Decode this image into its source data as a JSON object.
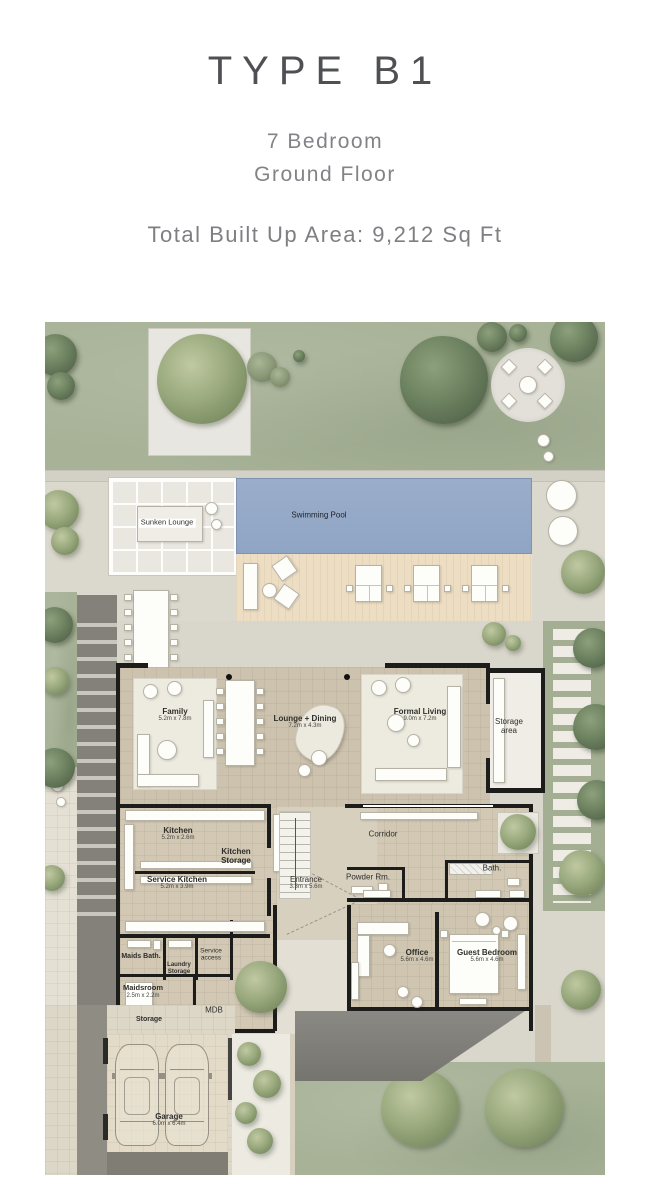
{
  "header": {
    "title": "TYPE B1",
    "subtitle_line1": "7 Bedroom",
    "subtitle_line2": "Ground Floor",
    "area_text": "Total Built Up Area: 9,212 Sq Ft"
  },
  "plan": {
    "labels": {
      "sunken_lounge": {
        "name": "Sunken Lounge",
        "dim": ""
      },
      "swimming_pool": {
        "name": "Swimming Pool",
        "dim": ""
      },
      "family": {
        "name": "Family",
        "dim": "5.2m x 7.8m"
      },
      "lounge_dining": {
        "name": "Lounge + Dining",
        "dim": "7.2m x 4.3m"
      },
      "formal_living": {
        "name": "Formal Living",
        "dim": "9.0m x 7.2m"
      },
      "storage_area": {
        "name": "Storage area",
        "dim": ""
      },
      "kitchen": {
        "name": "Kitchen",
        "dim": "5.2m x 2.6m"
      },
      "kitchen_storage": {
        "name": "Kitchen Storage",
        "dim": ""
      },
      "service_kitchen": {
        "name": "Service Kitchen",
        "dim": "5.2m x 3.9m"
      },
      "entrance": {
        "name": "Entrance",
        "dim": "3.3m x 5.6m"
      },
      "corridor": {
        "name": "Corridor",
        "dim": ""
      },
      "powder_rm": {
        "name": "Powder Rm.",
        "dim": ""
      },
      "bath": {
        "name": "Bath.",
        "dim": ""
      },
      "maids_bath": {
        "name": "Maids Bath.",
        "dim": ""
      },
      "laundry_storage": {
        "name": "Laundry Storage",
        "dim": ""
      },
      "service_access": {
        "name": "Service access",
        "dim": ""
      },
      "maidsroom": {
        "name": "Maidsroom",
        "dim": "2.5m x 2.2m"
      },
      "storage": {
        "name": "Storage",
        "dim": ""
      },
      "mdb": {
        "name": "MDB",
        "dim": ""
      },
      "office": {
        "name": "Office",
        "dim": "5.6m x 4.6m"
      },
      "guest_bedroom": {
        "name": "Guest Bedroom",
        "dim": "5.6m x 4.6m"
      },
      "garage": {
        "name": "Garage",
        "dim": "6.0m x 6.4m"
      }
    },
    "colors": {
      "lawn": "#a7b297",
      "pool": "#8fa5c4",
      "deck": "#ecddc3",
      "floor": "#cdc2ad",
      "paving": "#d9d6cb",
      "wall": "#1c1c1a"
    }
  }
}
